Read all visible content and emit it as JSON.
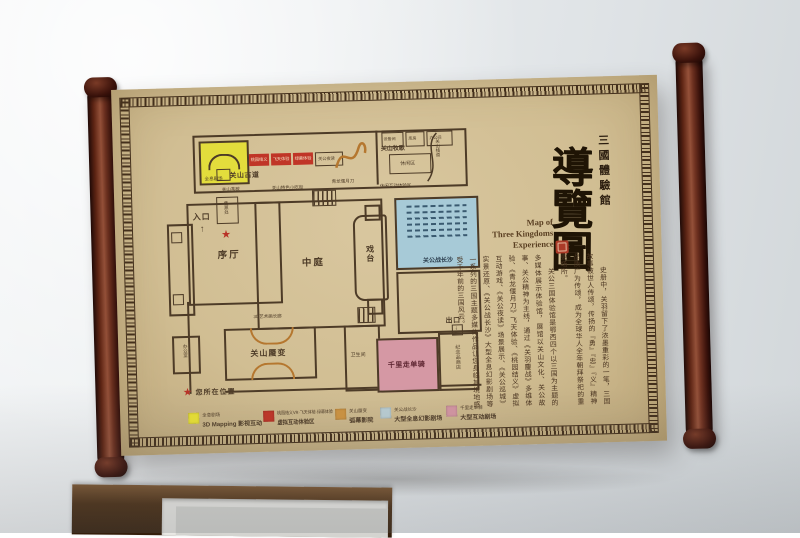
{
  "sign": {
    "hall_name": "三國體驗館",
    "title": "導覽圖",
    "title_en_lines": [
      "Map of",
      "Three Kingdoms",
      "Experience"
    ],
    "intro_paragraphs": [
      "史册中，关羽留下了浓墨重彩的一笔，三国故事被世人传颂，传扬的『勇』『忠』『义』精神品质广为传颂，成为全球华人全年朝拜祭祀的重要场所。",
      "关公三国体验馆是鄂西四个以三国为主题的多媒体展示体验馆，展馆以关山文化、关公故事、关公精神为主线，通过《关羽鏖战》多维体验、《青龙偃月刀》飞天体验、《桃园结义》虚拟互动游戏、《关公夜读》场景展示、《关公巡城》实景还原、《关公战长沙》大型全息幻影剧场等一系列的三国主题多媒体作品让您身临其境地感受千年前的三国风云。"
    ]
  },
  "floorplan": {
    "labels": {
      "entrance": "入口",
      "entrance_arrow": "↑",
      "ticket": "售票处",
      "lobby": "序厅",
      "atrium": "中庭",
      "stage": "戏台",
      "holo_theater": "全息剧场",
      "vr_taoyuan": "桃园结义",
      "vr_flying": "飞天体验",
      "vr_greenscreen": "绿幕体验",
      "night_reading": "关公夜读",
      "dragon_blade": "青龙偃月刀",
      "guanshan_road": "关山古道",
      "tea_break": "关山茶歇",
      "snack_street": "关山特色小吃街",
      "pasture_song": "关山牧歌",
      "rest_area": "休闲区",
      "plank_road": "关山栈道",
      "leisure_zone": "休闲互动体验区",
      "utility_room_1": "设备间",
      "utility_room_2": "库房",
      "utility_room_3": "办公间",
      "art_corridor": "3D艺术画长廊",
      "mirage": "关山蜃变",
      "office": "办公室",
      "restroom": "卫生间",
      "ride_alone": "千里走单骑",
      "souvenir_shop": "纪念品商店",
      "exit": "出口",
      "exit_arrow": "↓",
      "changsha_theater": "关公战长沙"
    },
    "you_are_here_star": "★",
    "you_are_here": "您所在位置"
  },
  "legend": {
    "items": [
      {
        "color": "#e8e034",
        "line1": "全息剧场",
        "line2": "3D Mapping 影视互动"
      },
      {
        "color": "#c03527",
        "line1": "桃园结义VR·飞天体验·绿幕体验",
        "line2": "虚拟互动体验区"
      },
      {
        "color": "#cd9340",
        "line1": "关山蜃变",
        "line2": "弧幕影院"
      },
      {
        "color": "#b9cdd2",
        "line1": "关公战长沙",
        "line2": "大型全息幻影剧场"
      },
      {
        "color": "#d395a2",
        "line1": "千里走单骑",
        "line2": "大型互动剧场"
      }
    ]
  },
  "colors": {
    "paper": "#d3c096",
    "roller": "#5a2317",
    "wall_line": "#4d3b27",
    "room_yellow": "#e3dd3c",
    "room_red": "#c03527",
    "room_blue": "#a7cad7",
    "room_pink": "#d598a4",
    "arc_orange": "#b5772f",
    "star_red": "#b83227"
  }
}
